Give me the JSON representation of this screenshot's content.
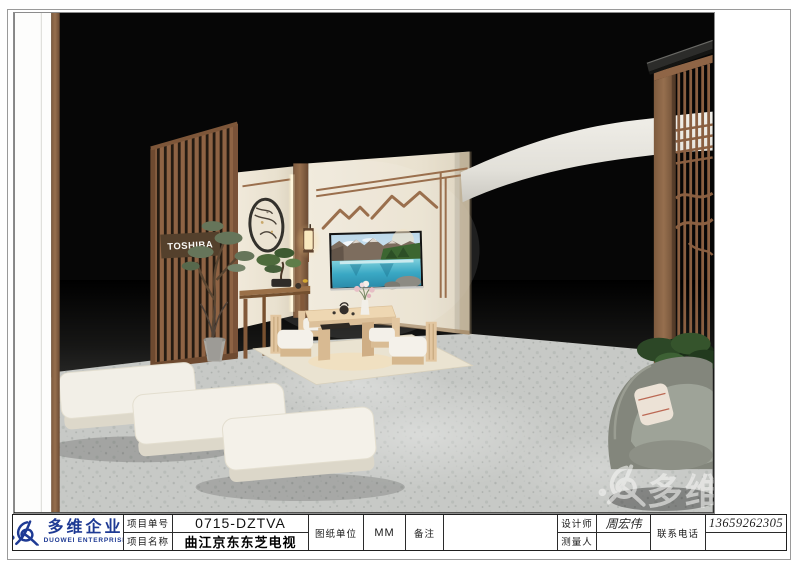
{
  "sheet": {
    "title_block": {
      "logo": {
        "company_cn": "多维企业",
        "company_en": "DUOWEI ENTERPRISE",
        "brand_blue": "#1e3a94"
      },
      "project_no_label": "项目单号",
      "project_no_value": "0715-DZTVA",
      "project_name_label": "项目名称",
      "project_name_value": "曲江京东东芝电视",
      "drawing_unit_label": "图纸单位",
      "drawing_unit_value": "MM",
      "remarks_label": "备注",
      "remarks_value": "",
      "designer_label": "设计师",
      "designer_value": "周宏伟",
      "surveyor_label": "测量人",
      "surveyor_value": "",
      "phone_label": "联系电话",
      "phone_value": "13659262305"
    }
  },
  "scene": {
    "brand_sign": "TOSHIBA",
    "watermark": {
      "text_cn": "多维企"
    },
    "colors": {
      "background": "#060606",
      "wall_cream": "#ece5d4",
      "wood": "#8f6546",
      "floor_light": "#c7c9c6",
      "floor_dark": "#3f3f3d",
      "canopy_white": "#eceae3",
      "tv_lake_teal": "#3aa8c4",
      "bench_white": "#f2efe7",
      "chair_gray": "#83867c"
    }
  }
}
